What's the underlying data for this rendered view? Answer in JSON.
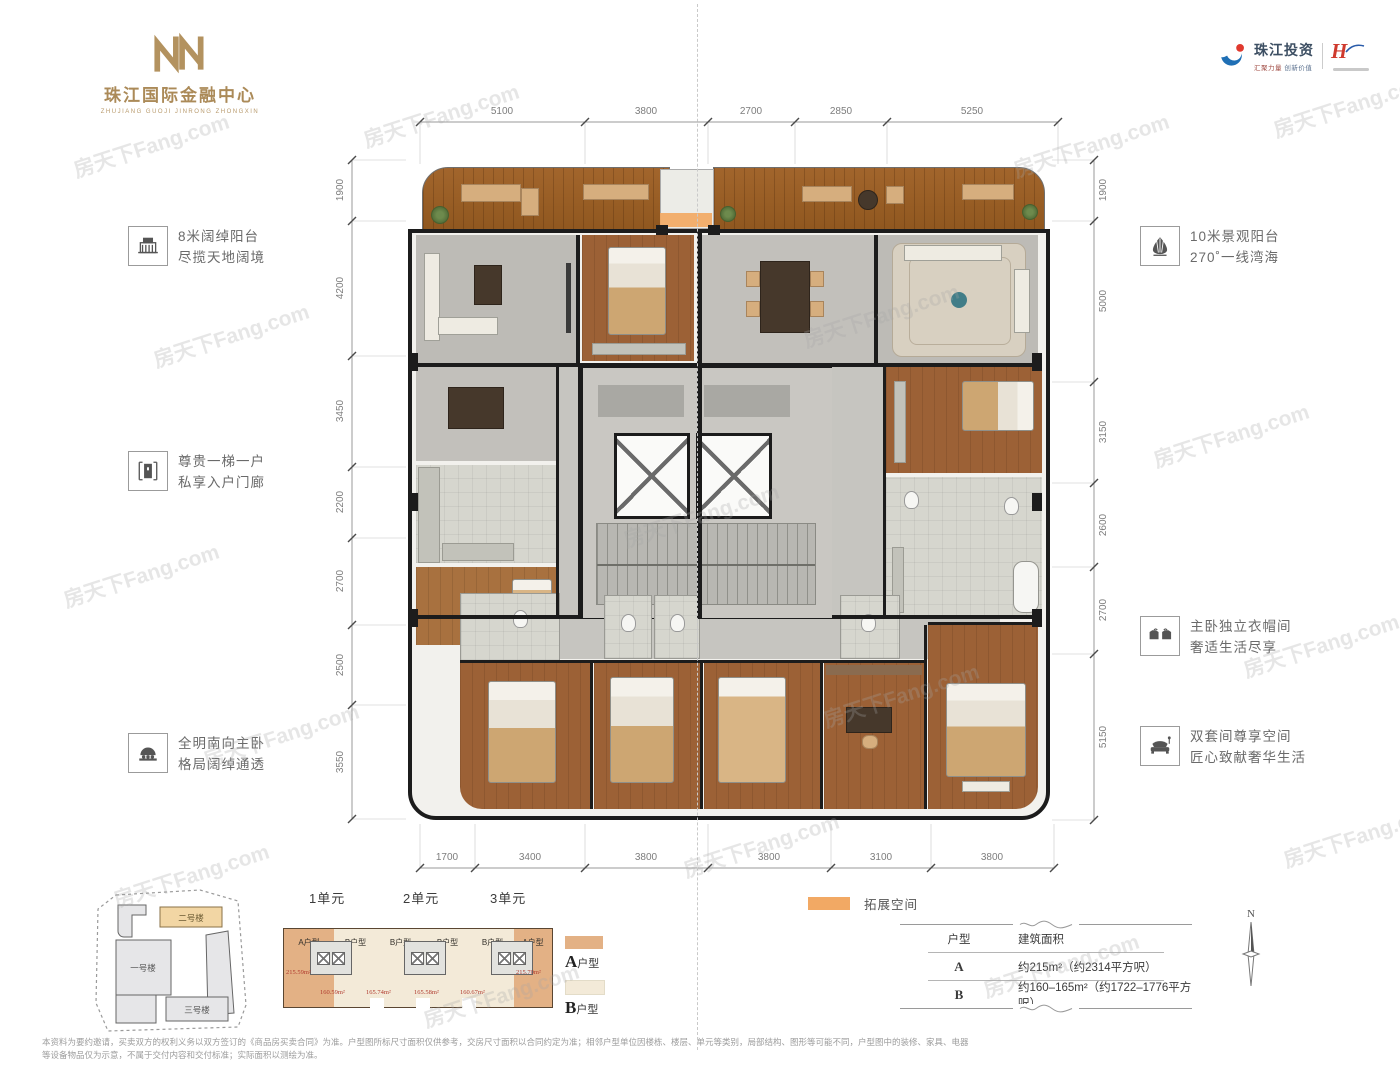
{
  "brand": {
    "title": "珠江国际金融中心",
    "subtitle": "ZHUJIANG GUOJI JINRONG ZHONGXIN"
  },
  "partners": {
    "name": "珠江投资",
    "tagline_left": "汇聚力量",
    "tagline_right": "创新价值",
    "mark": "H"
  },
  "watermark": "房天下Fang.com",
  "features_left": [
    {
      "icon": "balcony-icon",
      "title": "8米阔绰阳台",
      "desc": "尽揽天地阔境"
    },
    {
      "icon": "entry-door-icon",
      "title": "尊贵一梯一户",
      "desc": "私享入户门廊"
    },
    {
      "icon": "bed-icon",
      "title": "全明南向主卧",
      "desc": "格局阔绰通透"
    }
  ],
  "features_right": [
    {
      "icon": "shell-icon",
      "title": "10米景观阳台",
      "desc": "270˚一线湾海"
    },
    {
      "icon": "wardrobe-icon",
      "title": "主卧独立衣帽间",
      "desc": "奢适生活尽享"
    },
    {
      "icon": "sofa-icon",
      "title": "双套间尊享空间",
      "desc": "匠心致献奢华生活"
    }
  ],
  "dimensions": {
    "top": [
      "5100",
      "3800",
      "2700",
      "2850",
      "5250"
    ],
    "left": [
      "1900",
      "4200",
      "3450",
      "2200",
      "2700",
      "2500",
      "3550"
    ],
    "right": [
      "1900",
      "5000",
      "3150",
      "2600",
      "2700",
      "5150"
    ],
    "bottom": [
      "1700",
      "3400",
      "3800",
      "3800",
      "3100",
      "3800"
    ]
  },
  "site_plan": {
    "building_1": "一号楼",
    "building_2": "二号楼",
    "building_3": "三号楼"
  },
  "key_plan": {
    "units": [
      "1单元",
      "2单元",
      "3单元"
    ],
    "sections": [
      {
        "label": "A户型",
        "area": "215.59m²"
      },
      {
        "label": "B户型",
        "area": "160.59m²"
      },
      {
        "label": "B户型",
        "area": "165.74m²"
      },
      {
        "label": "B户型",
        "area": "165.58m²"
      },
      {
        "label": "B户型",
        "area": "160.67m²"
      },
      {
        "label": "A户型",
        "area": "215.70m²"
      }
    ]
  },
  "legend": {
    "a_letter": "A",
    "a_suffix": "户型",
    "b_letter": "B",
    "b_suffix": "户型",
    "extension": "拓展空间"
  },
  "area_table": {
    "col_type": "户型",
    "col_area": "建筑面积",
    "rows": [
      {
        "type": "A",
        "area": "约215m²（约2314平方呎）"
      },
      {
        "type": "B",
        "area": "约160–165m²（约1722–1776平方呎）"
      }
    ]
  },
  "compass_label": "N",
  "disclaimer": "本资料为要约邀请，买卖双方的权利义务以双方签订的《商品房买卖合同》为准。户型图所标尺寸面积仅供参考，交房尺寸面积以合同约定为准；相邻户型单位因楼栋、楼层、单元等类别，局部结构、图形等可能不同，户型图中的装修、家具、电器等设备物品仅为示意，不属于交付内容和交付标准；实际面积以测绘为准。",
  "colors": {
    "gold": "#ab8a58",
    "extension_orange": "#f2a964",
    "type_a": "#e3b185",
    "type_b": "#f3ead8",
    "area_red": "#b03a2e"
  }
}
